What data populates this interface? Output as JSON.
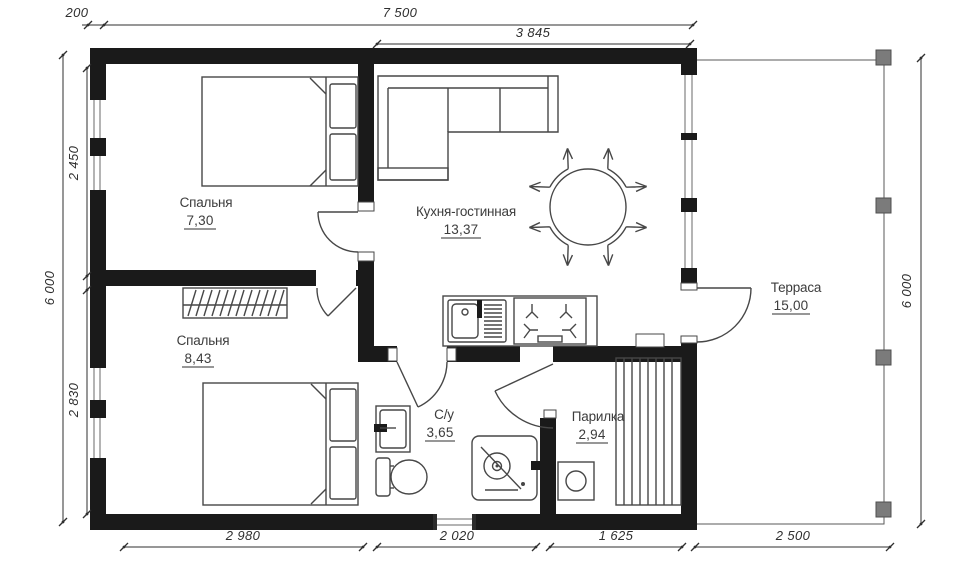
{
  "plan": {
    "type": "architectural-floor-plan",
    "rooms": [
      {
        "name": "Спальня",
        "area": "7,30"
      },
      {
        "name": "Кухня-гостинная",
        "area": "13,37"
      },
      {
        "name": "Спальня",
        "area": "8,43"
      },
      {
        "name": "С/у",
        "area": "3,65"
      },
      {
        "name": "Парилка",
        "area": "2,94"
      },
      {
        "name": "Терраса",
        "area": "15,00"
      }
    ],
    "dimensions": {
      "top_wall": "200",
      "top_total": "7 500",
      "top_kitchen": "3 845",
      "left_total": "6 000",
      "left_bedroom1": "2 450",
      "left_bedroom2": "2 830",
      "right_total": "6 000",
      "bottom_bedroom": "2 980",
      "bottom_bath": "2 020",
      "bottom_sauna": "1 625",
      "bottom_terrace": "2 500"
    },
    "colors": {
      "wall": "#1a1a1a",
      "line": "#474747",
      "dimension": "#2f2f2f",
      "post": "#7b7b7b",
      "background": "#ffffff"
    }
  }
}
